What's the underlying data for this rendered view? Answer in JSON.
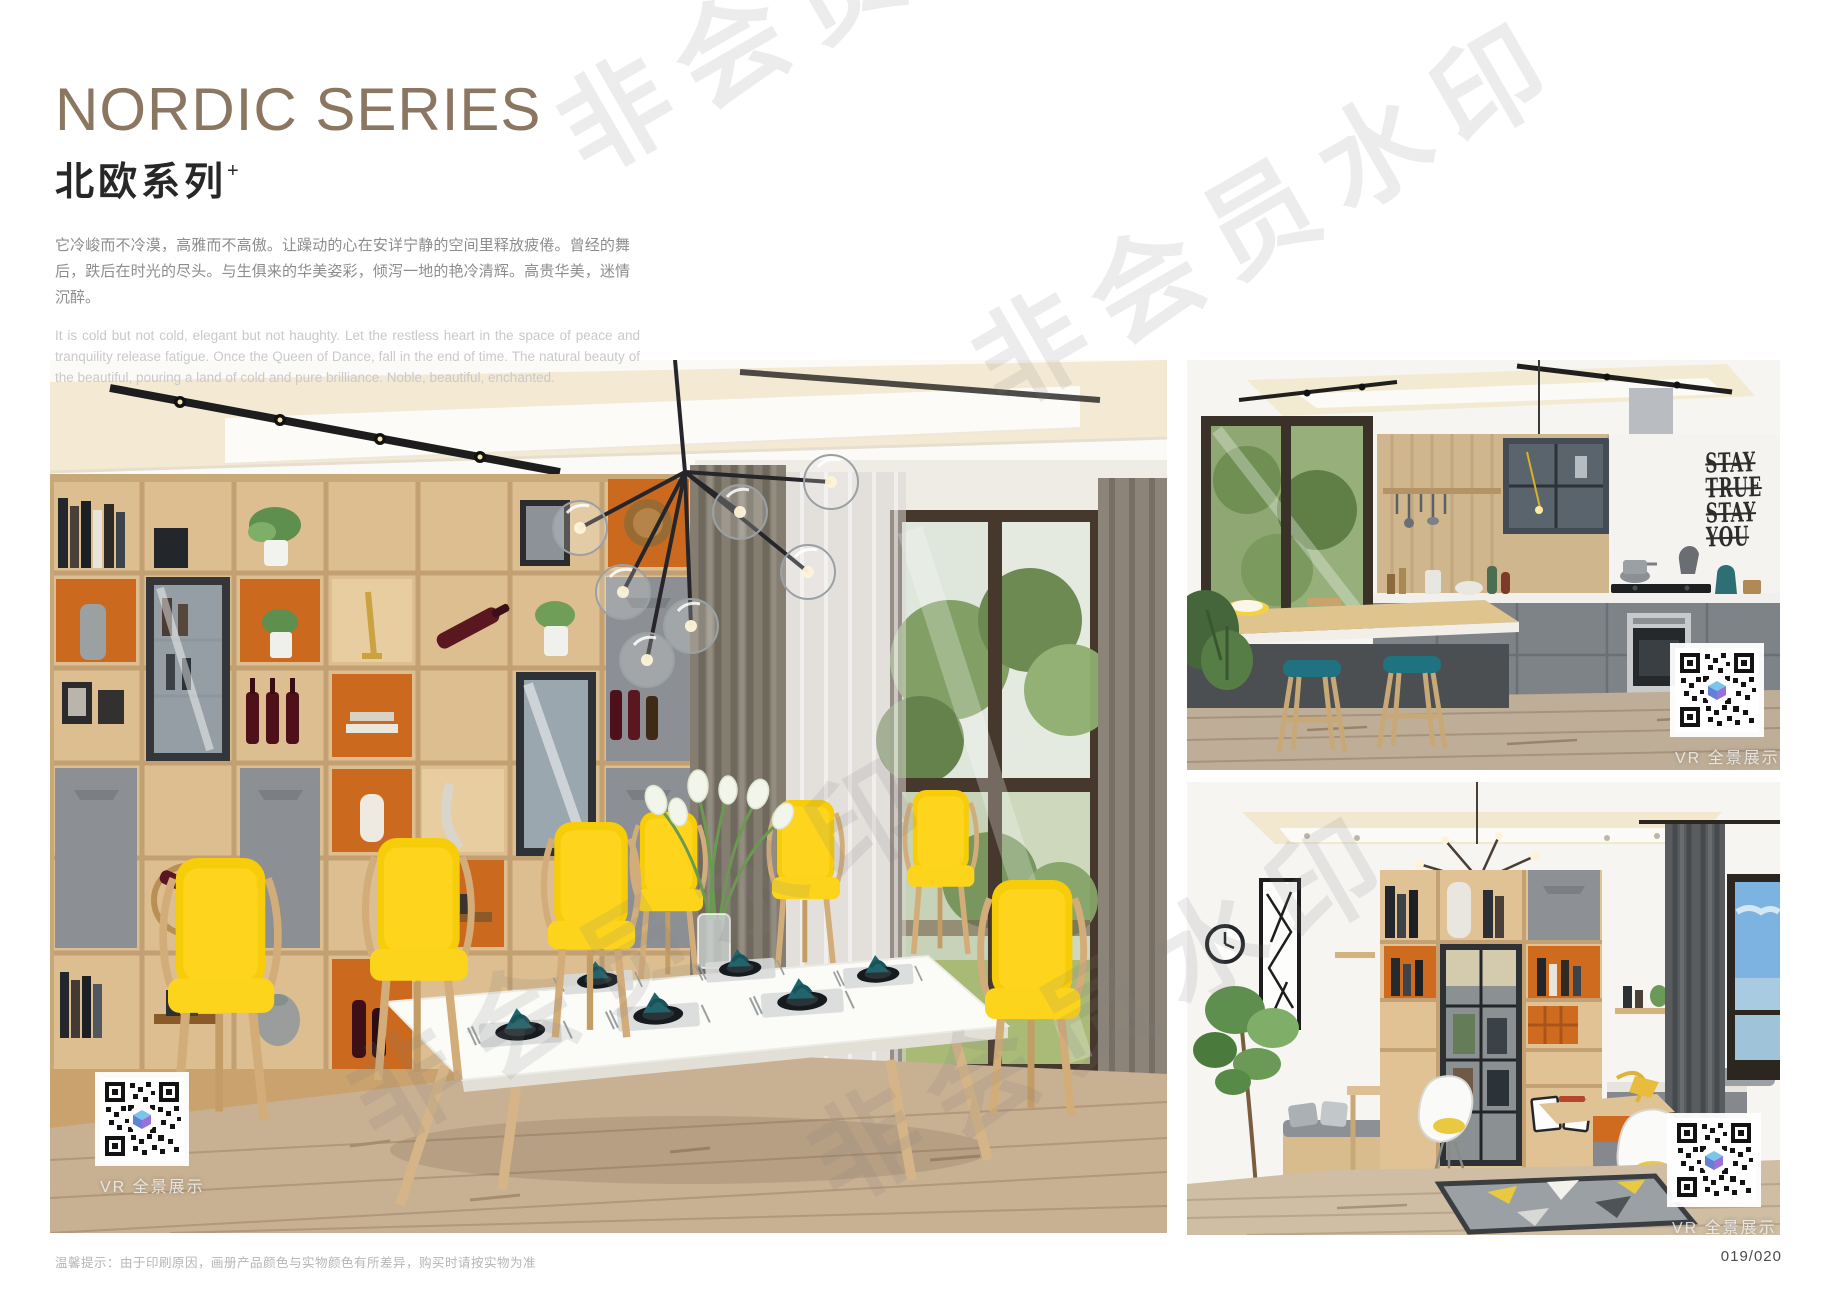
{
  "header": {
    "title_en": "NORDIC SERIES",
    "title_cn": "北欧系列",
    "title_superscript": "+",
    "paragraph_cn": "它冷峻而不冷漠，高雅而不高傲。让躁动的心在安详宁静的空间里释放疲倦。曾经的舞后，跌后在时光的尽头。与生俱来的华美姿彩，倾泻一地的艳冷清辉。高贵华美，迷情沉醉。",
    "paragraph_en": "It is cold but not cold, elegant but not haughty. Let the restless heart in the space of peace and tranquility release fatigue. Once the Queen of Dance, fall in the end of time. The natural beauty of the beautiful, pouring a land of cold and pure brilliance. Noble, beautiful, enchanted."
  },
  "gallery": {
    "vr_caption": "VR 全景展示",
    "kitchen_wall_decal": {
      "lines": [
        "STAY",
        "TRUE",
        "STAY",
        "YOU"
      ]
    }
  },
  "watermark": {
    "text": "非会员水印"
  },
  "footer": {
    "note": "温馨提示：由于印刷原因，画册产品颜色与实物颜色有所差异，购买时请按实物为准",
    "page_number": "019/020"
  },
  "colors": {
    "title_tan": "#8a7661",
    "accent_orange": "#cb6a1f",
    "chair_yellow": "#f7cc08",
    "napkin_teal": "#22646b",
    "stool_teal": "#1f7380",
    "cabinet_grey": "#8c9094",
    "wood_light": "#dcbe90",
    "watermark_grey": "#e9e9e9"
  }
}
